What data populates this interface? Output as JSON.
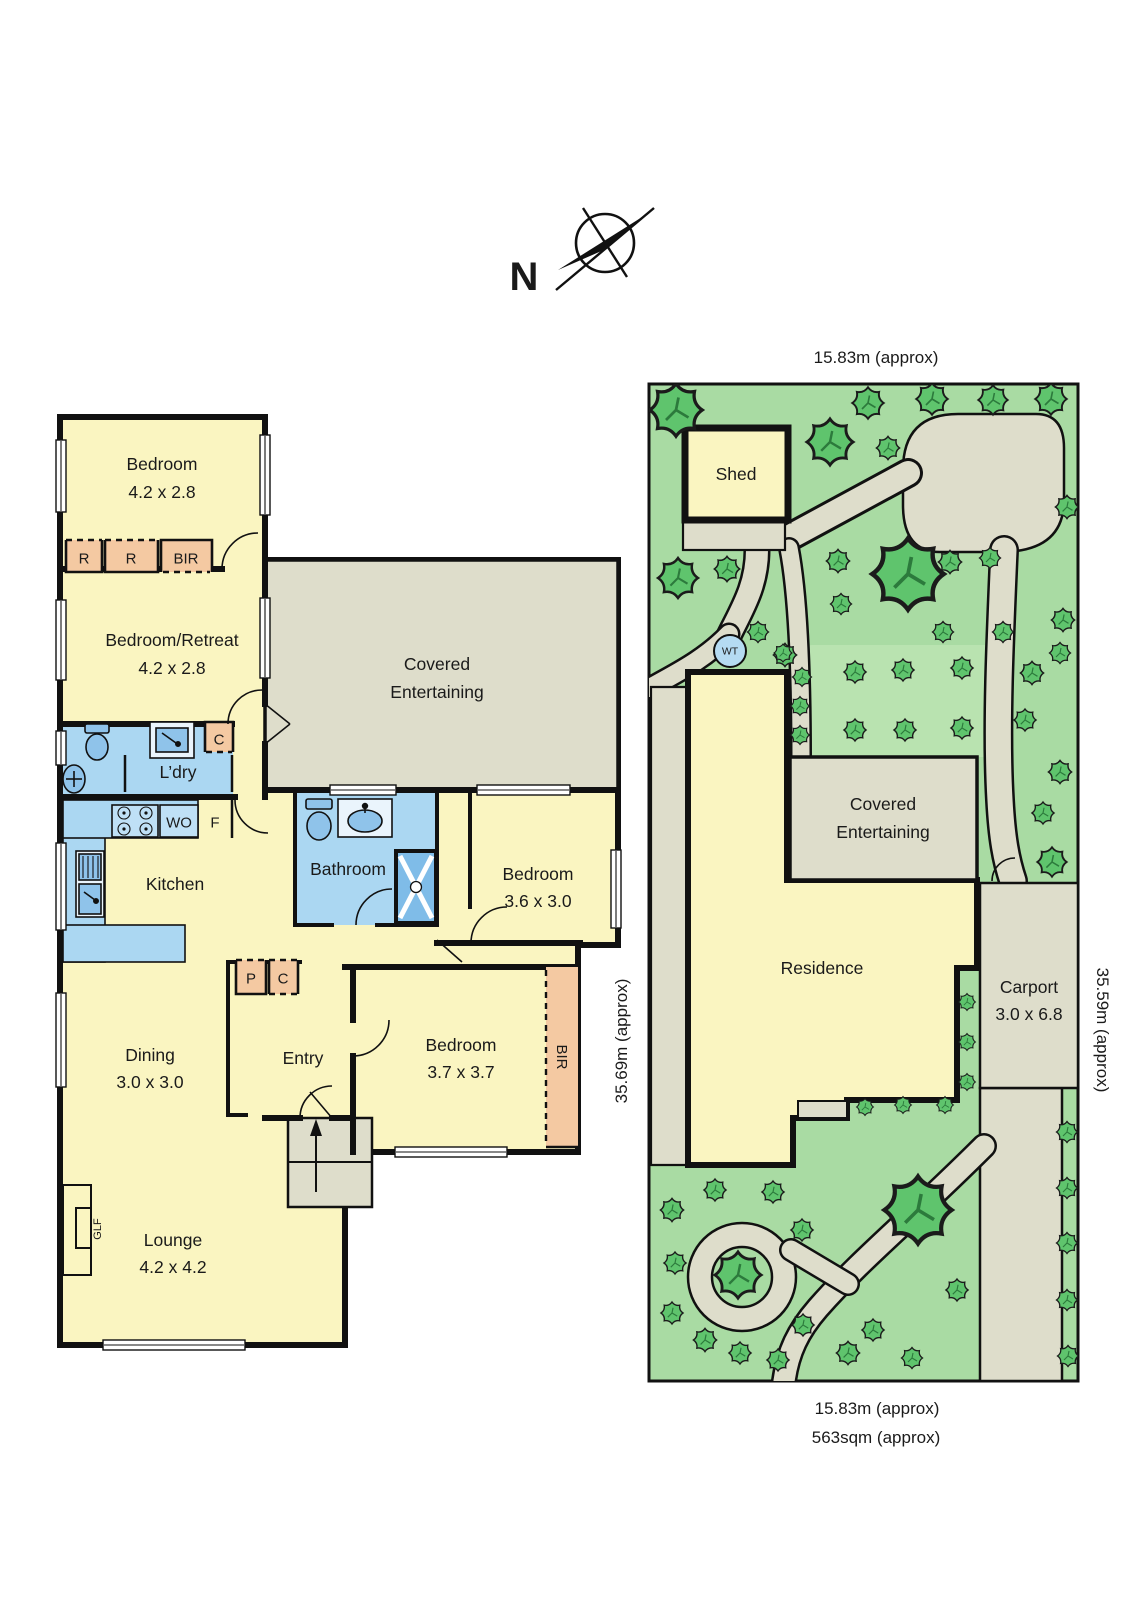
{
  "compass": {
    "n": "N"
  },
  "colors": {
    "room_fill": "#faf5c1",
    "wet_area_fill": "#abd7f2",
    "fixture_fill": "#8fc3ea",
    "closet_fill": "#f4c9a2",
    "outdoor_gray": "#deddcb",
    "lawn_green": "#a9dba3",
    "patch_green": "#b9e3b0",
    "tree_green": "#5fc46d",
    "water_tank_blue": "#b5dbf2",
    "wall_color": "#111111"
  },
  "floor_plan": {
    "rooms": [
      {
        "lines": [
          "Bedroom",
          "4.2 x 2.8"
        ]
      },
      {
        "lines": [
          "Bedroom/Retreat",
          "4.2 x 2.8"
        ]
      },
      {
        "lines": [
          "Covered",
          "Entertaining"
        ]
      },
      {
        "lines": [
          "L’dry"
        ]
      },
      {
        "lines": [
          "Kitchen"
        ]
      },
      {
        "lines": [
          "Bathroom"
        ]
      },
      {
        "lines": [
          "Bedroom",
          "3.6 x 3.0"
        ]
      },
      {
        "lines": [
          "Dining",
          "3.0 x 3.0"
        ]
      },
      {
        "lines": [
          "Entry"
        ]
      },
      {
        "lines": [
          "Bedroom",
          "3.7 x 3.7"
        ]
      },
      {
        "lines": [
          "Lounge",
          "4.2 x 4.2"
        ]
      }
    ],
    "small_labels": {
      "r1": "R",
      "r2": "R",
      "bir_top": "BIR",
      "c_laundry": "C",
      "wo": "WO",
      "fridge": "F",
      "pantry": "P",
      "c_hall": "C",
      "bir_side": "BIR",
      "glf": "GLF"
    }
  },
  "site_plan": {
    "shed": "Shed",
    "water_tank": "WT",
    "covered": [
      "Covered",
      "Entertaining"
    ],
    "residence": "Residence",
    "carport": [
      "Carport",
      "3.0 x 6.8"
    ],
    "dimensions": {
      "top": "15.83m (approx)",
      "bottom_width": "15.83m (approx)",
      "bottom_area": "563sqm (approx)",
      "left": "35.69m (approx)",
      "right": "35.59m (approx)"
    }
  }
}
